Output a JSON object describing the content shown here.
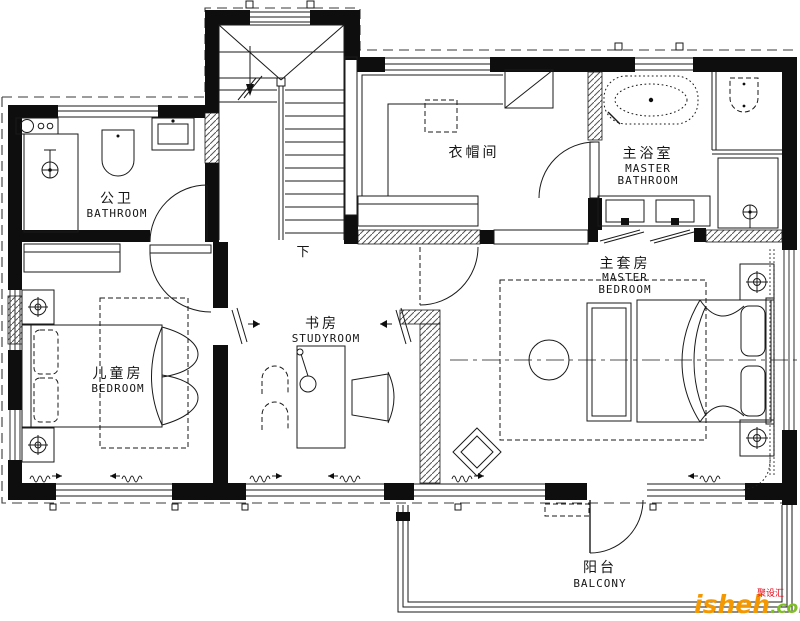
{
  "plan": {
    "rooms": {
      "public_bathroom": {
        "zh": "公卫",
        "en": "BATHROOM"
      },
      "cloakroom": {
        "zh": "衣帽间"
      },
      "master_bathroom": {
        "zh": "主浴室",
        "en_line1": "MASTER",
        "en_line2": "BATHROOM"
      },
      "master_bedroom": {
        "zh": "主套房",
        "en_line1": "MASTER",
        "en_line2": "BEDROOM"
      },
      "kids_bedroom": {
        "zh": "儿童房",
        "en": "BEDROOM"
      },
      "study": {
        "zh": "书房",
        "en": "STUDYROOM"
      },
      "balcony": {
        "zh": "阳台",
        "en": "BALCONY"
      }
    },
    "stairs": {
      "direction_label": "下"
    }
  },
  "watermark": {
    "site_name": "isheh",
    "site_tld": ".com",
    "brand_tag": "聚设汇",
    "orange": "#F39800",
    "green": "#7FBE26",
    "red": "#E60012"
  },
  "colors": {
    "line": "#1a1a1a",
    "background": "#ffffff"
  }
}
